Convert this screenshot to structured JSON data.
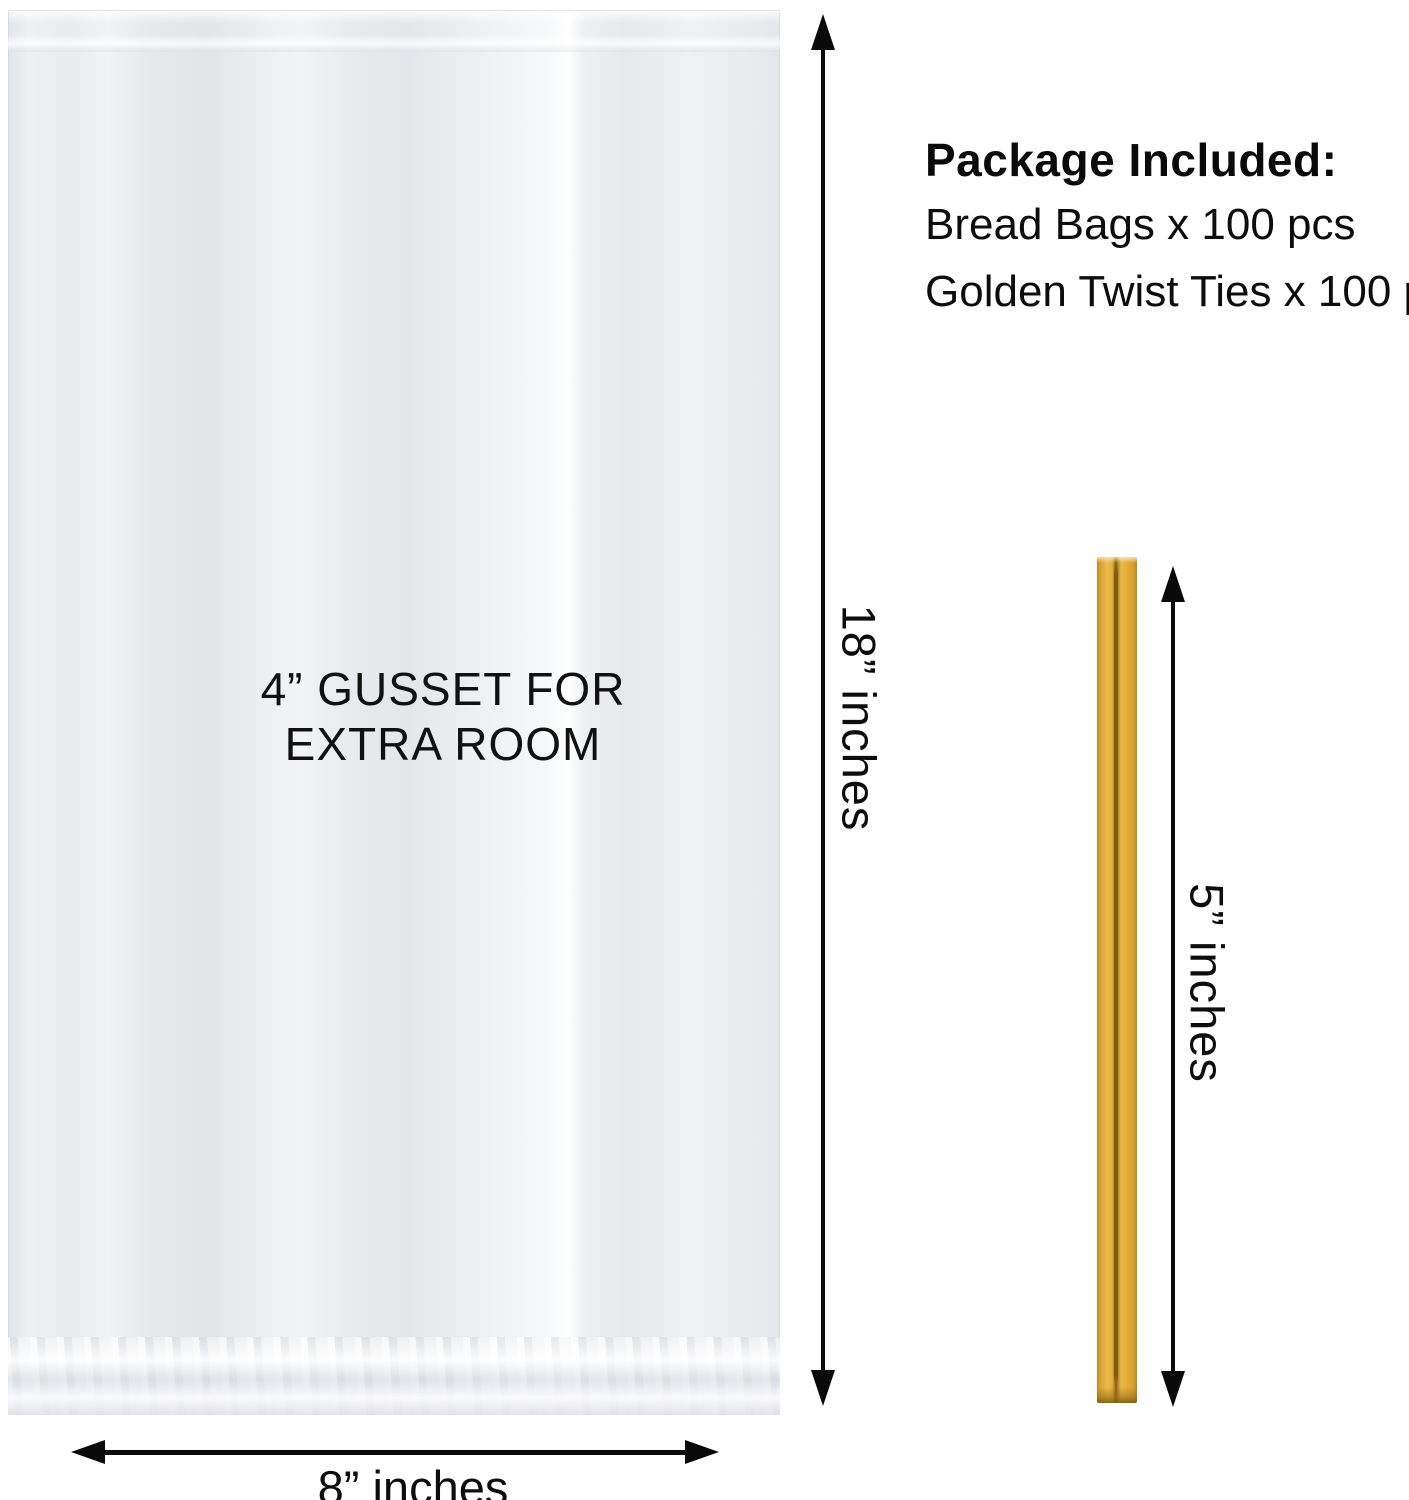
{
  "product_diagram": {
    "bag": {
      "gusset_label_line1": "4” GUSSET FOR",
      "gusset_label_line2": "EXTRA ROOM",
      "height_label": "18” inches",
      "width_label": "8” inches"
    },
    "package_included": {
      "heading": "Package Included:",
      "items": [
        "Bread Bags x 100 pcs",
        "Golden Twist Ties x 100 pcs"
      ]
    },
    "twist_tie": {
      "length_label": "5” inches",
      "color": "#E3AC3B"
    },
    "icons": {
      "bag_height_arrow": "double-headed-vertical-arrow",
      "bag_width_arrow": "double-headed-horizontal-arrow",
      "tie_length_arrow": "double-headed-vertical-arrow"
    },
    "colors": {
      "annotation": "#0a0a0a",
      "background": "#ffffff",
      "bag_film": "#eaecef"
    }
  }
}
